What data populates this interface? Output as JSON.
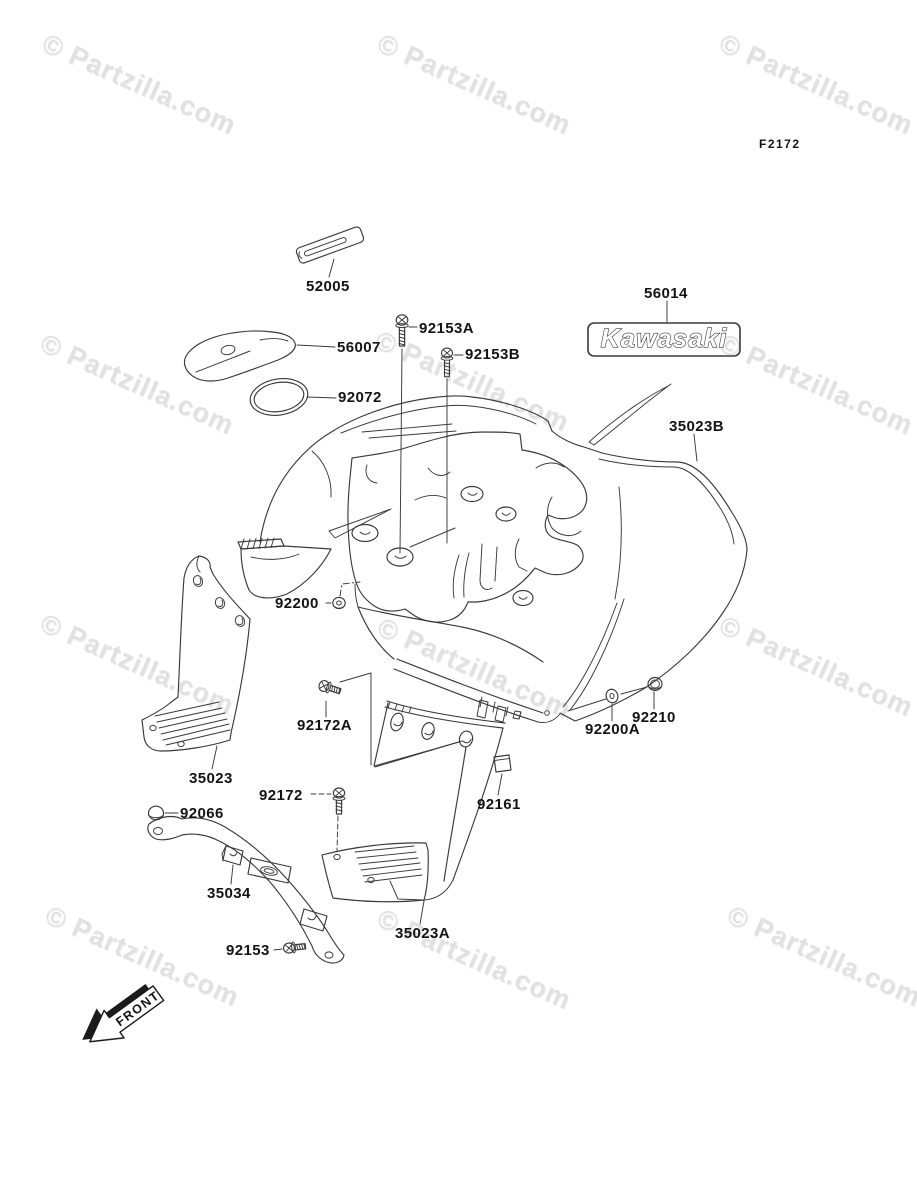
{
  "page": {
    "diagram_code": "F2172",
    "watermark": "© Partzilla.com",
    "front_indicator": "FRONT",
    "decal_text": "Kawasaki"
  },
  "parts": [
    {
      "number": "52005"
    },
    {
      "number": "56007"
    },
    {
      "number": "92072"
    },
    {
      "number": "92153A"
    },
    {
      "number": "92153B"
    },
    {
      "number": "56014"
    },
    {
      "number": "35023B"
    },
    {
      "number": "92200"
    },
    {
      "number": "92172A"
    },
    {
      "number": "35023"
    },
    {
      "number": "92066"
    },
    {
      "number": "92172"
    },
    {
      "number": "35034"
    },
    {
      "number": "92153"
    },
    {
      "number": "35023A"
    },
    {
      "number": "92161"
    },
    {
      "number": "92200A"
    },
    {
      "number": "92210"
    }
  ]
}
